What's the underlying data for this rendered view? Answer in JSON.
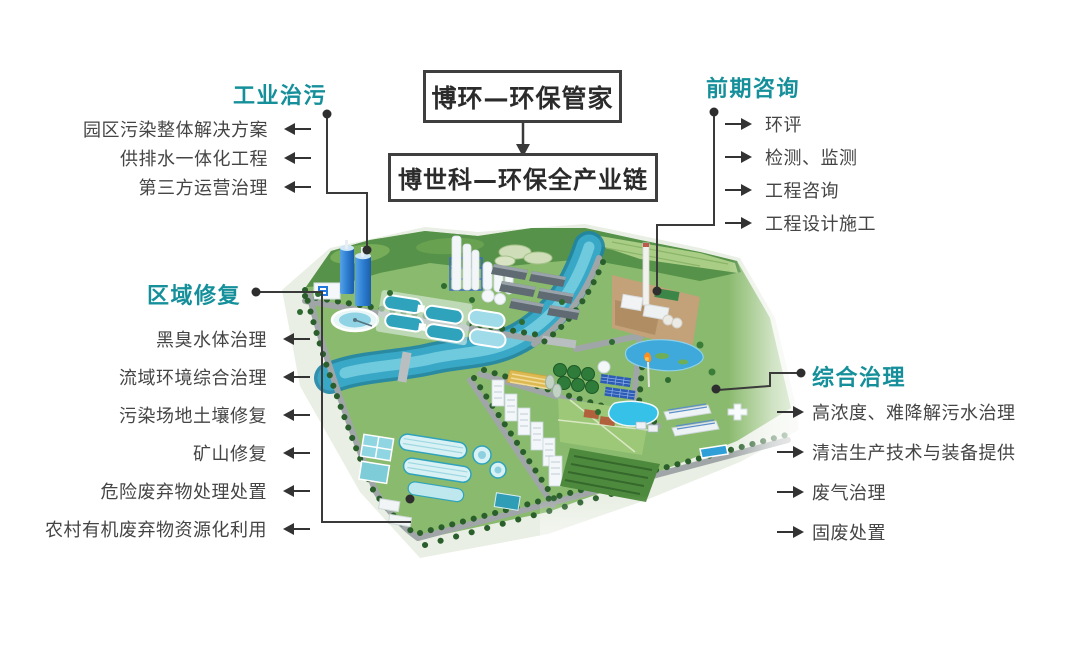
{
  "page": {
    "background": "#ffffff"
  },
  "colors": {
    "accent_teal": "#15909b",
    "body_text": "#454545",
    "connector_line": "#3a3a3a",
    "box_border": "#3f3f3f",
    "box_text": "#2b2b2b"
  },
  "icons": {
    "left_arrow": "◀",
    "right_arrow": "▶",
    "down_arrow": "▼",
    "connector_dot": "●"
  },
  "flow": {
    "top_box": "博环—环保管家",
    "bottom_box": "博世科—环保全产业链"
  },
  "groups": [
    {
      "title": "工业治污",
      "side": "left",
      "items": [
        "园区污染整体解决方案",
        "供排水一体化工程",
        "第三方运营治理"
      ]
    },
    {
      "title": "前期咨询",
      "side": "right",
      "items": [
        "环评",
        "检测、监测",
        "工程咨询",
        "工程设计施工"
      ]
    },
    {
      "title": "区域修复",
      "side": "left",
      "items": [
        "黑臭水体治理",
        "流域环境综合治理",
        "污染场地土壤修复",
        "矿山修复",
        "危险废弃物处理处置",
        "农村有机废弃物资源化利用"
      ]
    },
    {
      "title": "综合治理",
      "side": "right",
      "items": [
        "高浓度、难降解污水治理",
        "清洁生产技术与装备提供",
        "废气治理",
        "固废处置"
      ]
    }
  ],
  "illustration": {
    "name": "eco-industrial-park-aerial-view"
  }
}
